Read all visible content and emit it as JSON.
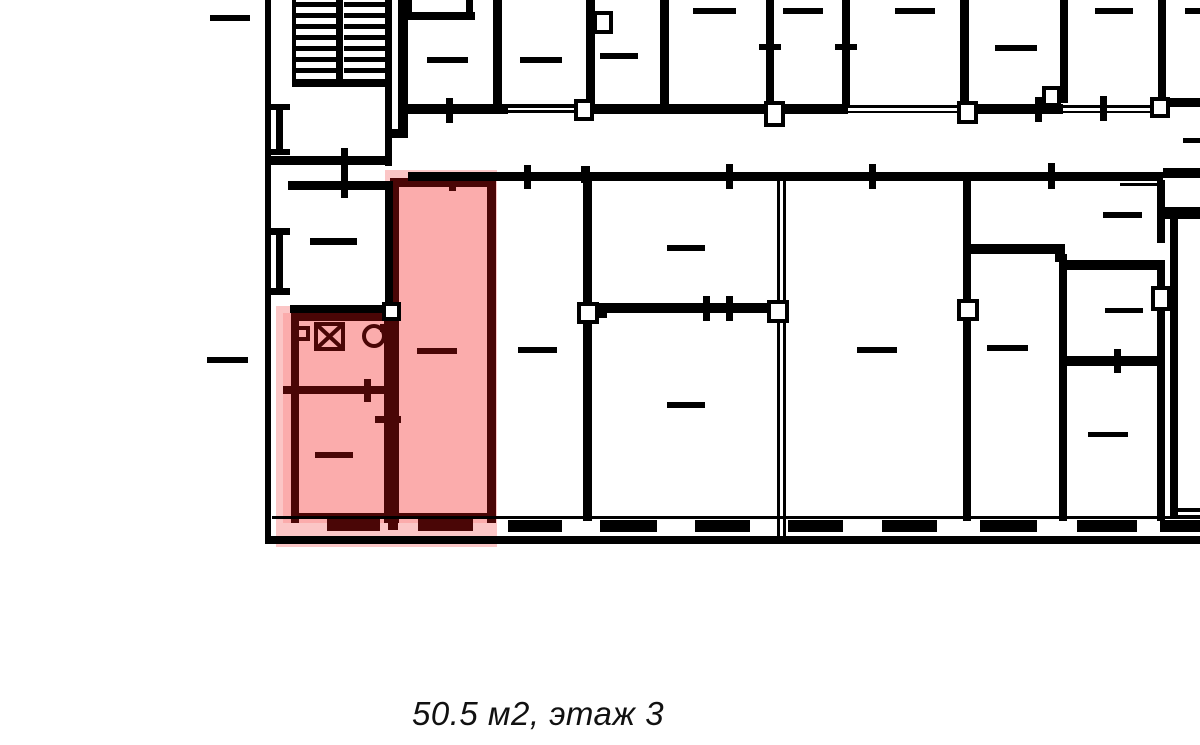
{
  "caption": {
    "text": "50.5 м2, этаж 3",
    "area": "50.5 м2",
    "floor": "этаж 3"
  },
  "colors": {
    "background": "#ffffff",
    "wall": "#000000",
    "unit-fill": "#fbacac",
    "unit-glow": "#fbc6c6",
    "unit-wall": "#4a0606",
    "caption": "#111111"
  },
  "plan": {
    "kind": "apartment floor plan with highlighted unit",
    "highlighted_unit": {
      "rooms_visible": 3,
      "fixture_icons": [
        "boiler-square-icon",
        "washer-x-icon",
        "toilet-icon"
      ]
    },
    "stairwell": {
      "flights": 2
    }
  }
}
